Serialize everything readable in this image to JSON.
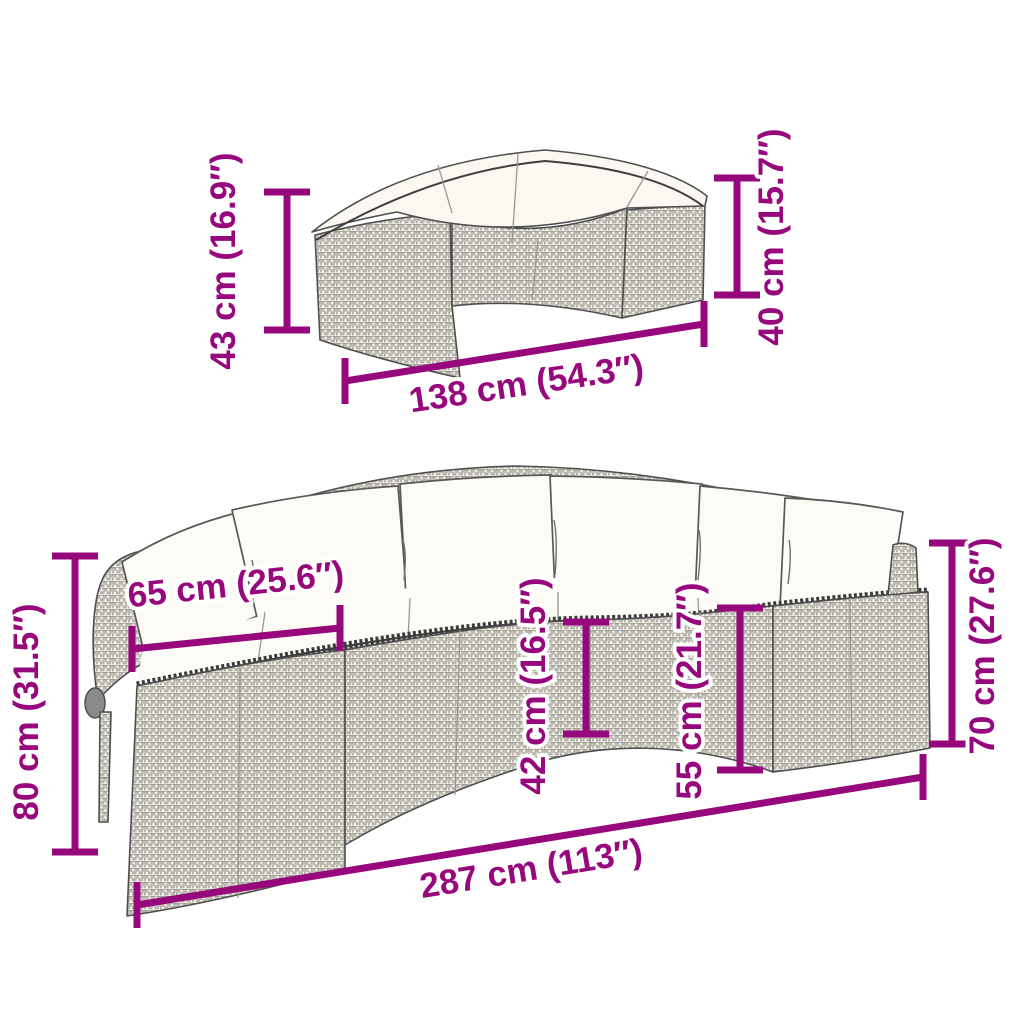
{
  "diagram": {
    "type": "product-dimension-diagram",
    "accent_color": "#98087d",
    "figures": [
      {
        "id": "bench",
        "name": "half-round-rattan-bench",
        "dimensions": [
          {
            "name": "height-left",
            "label": "43 cm (16.9″)"
          },
          {
            "name": "height-right",
            "label": "40 cm (15.7″)"
          },
          {
            "name": "width",
            "label": "138 cm (54.3″)"
          }
        ]
      },
      {
        "id": "sofa",
        "name": "half-round-rattan-sofa-with-cushions",
        "dimensions": [
          {
            "name": "overall-height",
            "label": "80 cm (31.5″)"
          },
          {
            "name": "seat-depth",
            "label": "65 cm (25.6″)"
          },
          {
            "name": "seat-height",
            "label": "42 cm (16.5″)"
          },
          {
            "name": "back-height",
            "label": "55 cm (21.7″)"
          },
          {
            "name": "armrest-height",
            "label": "70 cm (27.6″)"
          },
          {
            "name": "overall-width",
            "label": "287 cm (113″)"
          }
        ]
      }
    ]
  }
}
